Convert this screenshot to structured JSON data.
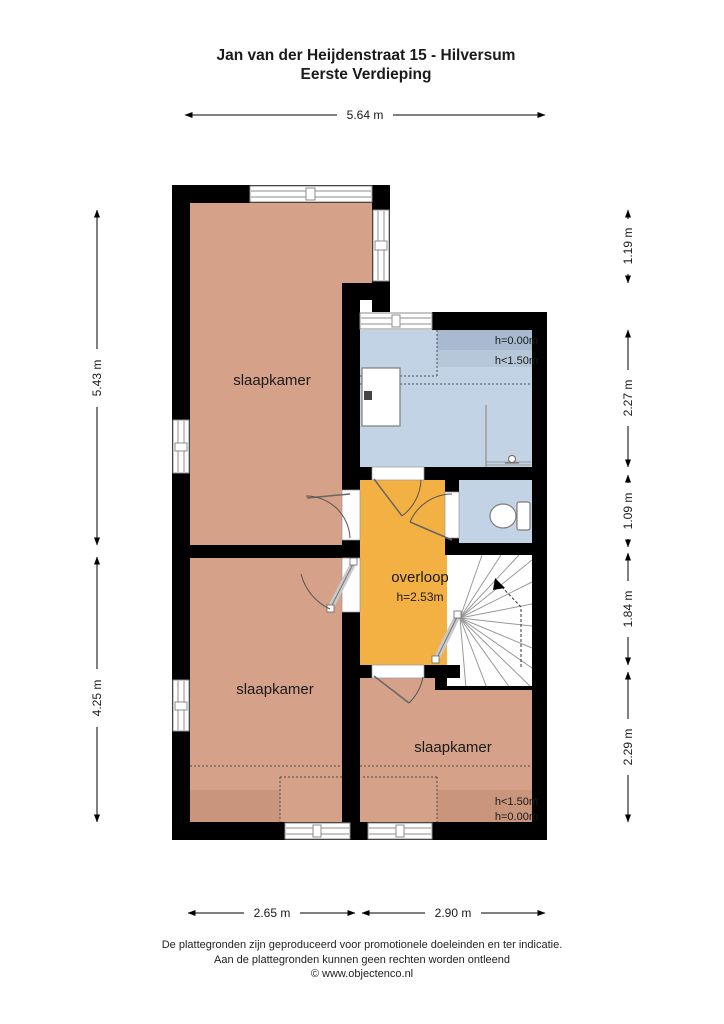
{
  "title": {
    "line1": "Jan van der Heijdenstraat 15 - Hilversum",
    "line2": "Eerste Verdieping"
  },
  "dimensions": {
    "top": "5.64 m",
    "left_upper": "5.43 m",
    "left_lower": "4.25 m",
    "right_1": "1.19 m",
    "right_2": "2.27 m",
    "right_3": "1.09 m",
    "right_4": "1.84 m",
    "right_5": "2.29 m",
    "bottom_left": "2.65 m",
    "bottom_right": "2.90 m"
  },
  "rooms": {
    "bedroom_top": {
      "label": "slaapkamer"
    },
    "bedroom_bottom_left": {
      "label": "slaapkamer"
    },
    "bedroom_bottom_right": {
      "label": "slaapkamer",
      "height_low": "h<1.50m",
      "height_zero": "h=0.00m"
    },
    "landing": {
      "label": "overloop",
      "height": "h=2.53m"
    },
    "bathroom": {
      "height_zero": "h=0.00m",
      "height_low": "h<1.50m"
    }
  },
  "footer": {
    "line1": "De plattegronden zijn geproduceerd voor promotionele doeleinden en ter indicatie.",
    "line2": "Aan de plattegronden kunnen geen rechten worden ontleend",
    "line3": "© www.objectenco.nl"
  },
  "colors": {
    "wall": "#000000",
    "bedroom": "#d5a189",
    "bedroom_shaded": "#c9957c",
    "landing": "#f4b143",
    "bathroom": "#c3d3e6",
    "bathroom_shade_dark": "#a8bacf",
    "bathroom_shade_mid": "#b6c7da"
  }
}
